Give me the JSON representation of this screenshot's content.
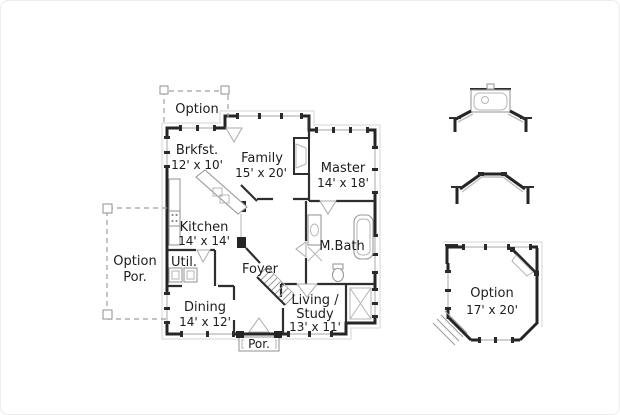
{
  "canvas": {
    "background": "#ffffff",
    "wall_color": "#252525",
    "light_line_color": "#b8b8b8",
    "text_color": "#1d1d1d"
  },
  "rooms": {
    "option_top": {
      "name": "Option"
    },
    "brkfst": {
      "name": "Brkfst.",
      "dims": "12' x 10'"
    },
    "family": {
      "name": "Family",
      "dims": "15' x 20'"
    },
    "master": {
      "name": "Master",
      "dims": "14' x 18'"
    },
    "kitchen": {
      "name": "Kitchen",
      "dims": "14' x 14'"
    },
    "util": {
      "name": "Util."
    },
    "option_por": {
      "name": "Option",
      "name2": "Por."
    },
    "foyer": {
      "name": "Foyer"
    },
    "mbath": {
      "name": "M.Bath"
    },
    "dining": {
      "name": "Dining",
      "dims": "14' x 12'"
    },
    "living": {
      "name": "Living /",
      "name2": "Study",
      "dims": "13' x 11'"
    },
    "por": {
      "name": "Por."
    },
    "option_right": {
      "name": "Option",
      "dims": "17' x 20'"
    }
  }
}
